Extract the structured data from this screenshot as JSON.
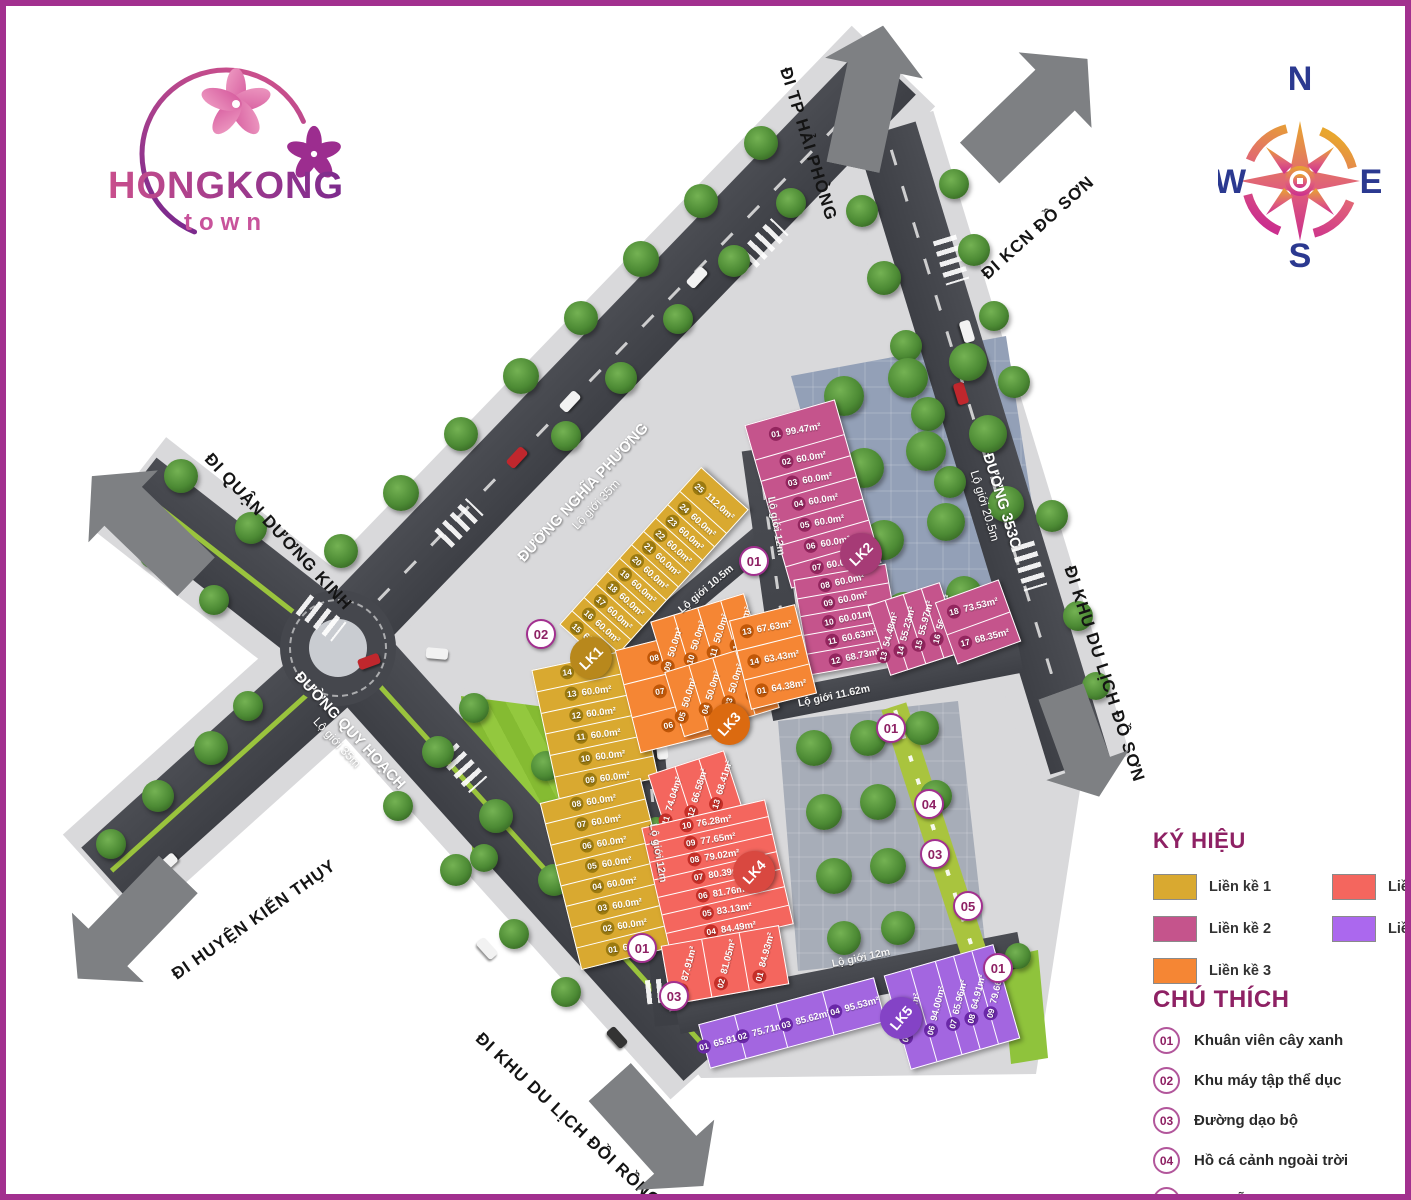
{
  "logo": {
    "title": "HONGKONG",
    "subtitle": "town"
  },
  "compass": {
    "n": "N",
    "e": "E",
    "s": "S",
    "w": "W"
  },
  "theme": {
    "border": "#a2308f",
    "accent": "#8e2164",
    "road": "#45474d",
    "sidewalk": "#d9d9db",
    "arrow": "#7e8083",
    "navy": "#2b3990"
  },
  "roads": {
    "destinations": [
      "ĐI TP HẢI PHÒNG",
      "ĐI KCN ĐỒ SƠN",
      "ĐI QUẬN DƯƠNG KINH",
      "ĐI HUYỆN KIẾN THỤY",
      "ĐI KHU DU LỊCH ĐỒI RỒNG",
      "ĐI KHU DU LỊCH ĐỒ SƠN"
    ],
    "names": [
      {
        "name": "ĐƯỜNG NGHĨA PHƯƠNG",
        "sub": "Lộ giới 35m"
      },
      {
        "name": "ĐƯỜNG QUY HOẠCH",
        "sub": "Lộ giới 35m"
      },
      {
        "name": "ĐƯỜNG 353C",
        "sub": "Lộ giới 20.5m"
      }
    ],
    "internal": [
      "Lộ giới 12m",
      "Lộ giới 10.5m",
      "Lộ giới 11.62m",
      "Lộ giới 12m",
      "Lộ giới 12m"
    ]
  },
  "blocks": [
    {
      "id": "LK1",
      "name": "Liền kề 1",
      "color": "#d9a930",
      "badge": "#b8881c",
      "chip": "#9b7a10",
      "groups": {
        "north": [
          {
            "no": "15",
            "area": "60.0m²"
          },
          {
            "no": "16",
            "area": "60.0m²"
          },
          {
            "no": "17",
            "area": "60.0m²"
          },
          {
            "no": "18",
            "area": "60.0m²"
          },
          {
            "no": "19",
            "area": "60.0m²"
          },
          {
            "no": "20",
            "area": "60.0m²"
          },
          {
            "no": "21",
            "area": "60.0m²"
          },
          {
            "no": "22",
            "area": "60.0m²"
          },
          {
            "no": "23",
            "area": "60.0m²"
          },
          {
            "no": "24",
            "area": "60.0m²"
          },
          {
            "no": "25",
            "area": "112.0m²"
          }
        ],
        "mid": [
          {
            "no": "14",
            "area": "60.0m²"
          },
          {
            "no": "13",
            "area": "60.0m²"
          },
          {
            "no": "12",
            "area": "60.0m²"
          },
          {
            "no": "11",
            "area": "60.0m²"
          },
          {
            "no": "10",
            "area": "60.0m²"
          },
          {
            "no": "09",
            "area": "60.0m²"
          }
        ],
        "south": [
          {
            "no": "08",
            "area": "60.0m²"
          },
          {
            "no": "07",
            "area": "60.0m²"
          },
          {
            "no": "06",
            "area": "60.0m²"
          },
          {
            "no": "05",
            "area": "60.0m²"
          },
          {
            "no": "04",
            "area": "60.0m²"
          },
          {
            "no": "03",
            "area": "60.0m²"
          },
          {
            "no": "02",
            "area": "60.0m²"
          },
          {
            "no": "01",
            "area": "62.4m²"
          }
        ]
      }
    },
    {
      "id": "LK2",
      "name": "Liền kề 2",
      "color": "#c5548c",
      "badge": "#a63b76",
      "chip": "#93255e",
      "groups": {
        "main": [
          {
            "no": "01",
            "area": "99.47m²"
          },
          {
            "no": "02",
            "area": "60.0m²"
          },
          {
            "no": "03",
            "area": "60.0m²"
          },
          {
            "no": "04",
            "area": "60.0m²"
          },
          {
            "no": "05",
            "area": "60.0m²"
          },
          {
            "no": "06",
            "area": "60.0m²"
          },
          {
            "no": "07",
            "area": "60.0m²"
          }
        ],
        "west": [
          {
            "no": "08",
            "area": "60.0m²"
          },
          {
            "no": "09",
            "area": "60.0m²"
          },
          {
            "no": "10",
            "area": "60.01m²"
          },
          {
            "no": "11",
            "area": "60.63m²"
          },
          {
            "no": "12",
            "area": "68.73m²"
          }
        ],
        "east_slices": [
          {
            "no": "13",
            "area": "54.48m²"
          },
          {
            "no": "14",
            "area": "55.23m²"
          },
          {
            "no": "15",
            "area": "55.97m²"
          },
          {
            "no": "16",
            "area": "56.61m²"
          }
        ],
        "east_pair": [
          {
            "no": "18",
            "area": "73.53m²"
          },
          {
            "no": "17",
            "area": "68.35m²"
          }
        ]
      }
    },
    {
      "id": "LK3",
      "name": "Liền kề 3",
      "color": "#f58634",
      "badge": "#db6a10",
      "chip": "#c05708",
      "groups": {
        "west": [
          {
            "no": "08",
            "area": "66.7m²"
          },
          {
            "no": "07",
            "area": "65.15m²"
          },
          {
            "no": "06",
            "area": "70.33m²"
          }
        ],
        "north_slices": [
          {
            "no": "09",
            "area": "50.0m²"
          },
          {
            "no": "10",
            "area": "50.0m²"
          },
          {
            "no": "11",
            "area": "50.0m²"
          },
          {
            "no": "12",
            "area": "50.0m²"
          }
        ],
        "south_slices": [
          {
            "no": "05",
            "area": "50.0m²"
          },
          {
            "no": "04",
            "area": "50.0m²"
          },
          {
            "no": "03",
            "area": "50.0m²"
          },
          {
            "no": "02",
            "area": "50.0m²"
          }
        ],
        "east": [
          {
            "no": "13",
            "area": "67.63m²"
          },
          {
            "no": "14",
            "area": "63.43m²"
          },
          {
            "no": "01",
            "area": "64.38m²"
          }
        ]
      }
    },
    {
      "id": "LK4",
      "name": "Liền kề 4",
      "color": "#f4665e",
      "badge": "#d94840",
      "chip": "#c52f28",
      "groups": {
        "north_slices": [
          {
            "no": "11",
            "area": "74.04m²"
          },
          {
            "no": "12",
            "area": "66.58m²"
          },
          {
            "no": "13",
            "area": "68.41m²"
          }
        ],
        "main": [
          {
            "no": "10",
            "area": "76.28m²"
          },
          {
            "no": "09",
            "area": "77.65m²"
          },
          {
            "no": "08",
            "area": "79.02m²"
          },
          {
            "no": "07",
            "area": "80.39m²"
          },
          {
            "no": "06",
            "area": "81.76m²"
          },
          {
            "no": "05",
            "area": "83.13m²"
          },
          {
            "no": "04",
            "area": "84.49m²"
          }
        ],
        "south_slices": [
          {
            "no": "03",
            "area": "87.91m²"
          },
          {
            "no": "02",
            "area": "81.05m²"
          },
          {
            "no": "01",
            "area": "84.93m²"
          }
        ]
      }
    },
    {
      "id": "LK5",
      "name": "Liền kề 5",
      "color": "#a366e0",
      "badge": "#8443c6",
      "chip": "#6a28a8",
      "groups": {
        "west_strip": [
          {
            "no": "01",
            "area": "65.81m²"
          },
          {
            "no": "02",
            "area": "75.71m²"
          },
          {
            "no": "03",
            "area": "85.62m²"
          },
          {
            "no": "04",
            "area": "95.53m²"
          }
        ],
        "east_slices": [
          {
            "no": "05",
            "area": "95.16m²"
          },
          {
            "no": "06",
            "area": "94.00m²"
          },
          {
            "no": "07",
            "area": "65.96m²"
          },
          {
            "no": "08",
            "area": "64.91m²"
          },
          {
            "no": "09",
            "area": "79.66m²"
          }
        ]
      }
    }
  ],
  "markers": [
    "01",
    "02",
    "01",
    "03",
    "01",
    "04",
    "03",
    "05",
    "01"
  ],
  "legend": {
    "title": "KÝ HIỆU",
    "items": [
      {
        "label": "Liền kề 1",
        "color": "#d9a930"
      },
      {
        "label": "Liền kề 2",
        "color": "#c5548c"
      },
      {
        "label": "Liền kề 3",
        "color": "#f58634"
      },
      {
        "label": "Liền kề 4",
        "color": "#f4665e"
      },
      {
        "label": "Liền kề 5",
        "color": "#ab68ee"
      }
    ]
  },
  "notes": {
    "title": "CHÚ THÍCH",
    "items": [
      {
        "no": "01",
        "label": "Khuân viên cây xanh"
      },
      {
        "no": "02",
        "label": "Khu máy tập thể dục"
      },
      {
        "no": "03",
        "label": "Đường dạo bộ"
      },
      {
        "no": "04",
        "label": "Hồ cá cảnh ngoài trời"
      },
      {
        "no": "05",
        "label": "Khu đỗ xe"
      }
    ]
  }
}
